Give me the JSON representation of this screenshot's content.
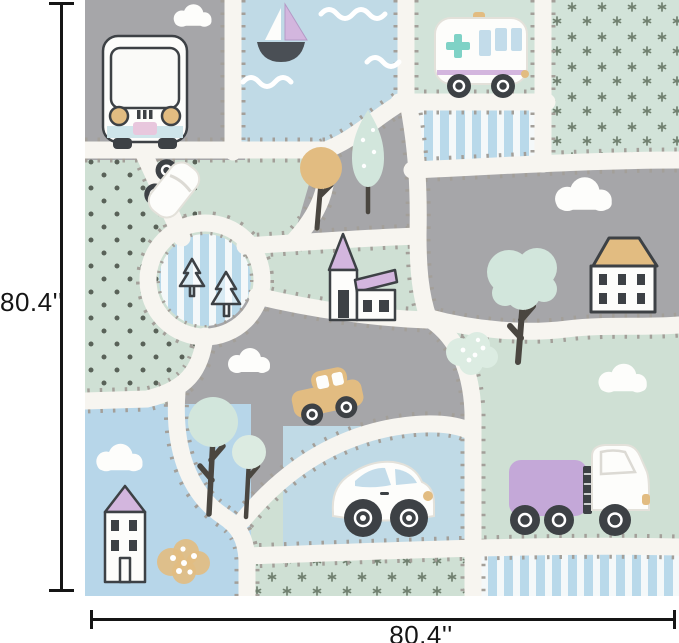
{
  "figure": {
    "kind": "product-dimension-figure",
    "subject": "kids-road-play-rug"
  },
  "dimensions": {
    "height_label": "80.4''",
    "width_label": "80.4''"
  },
  "rug": {
    "motifs": [
      "camper-van-front",
      "cloud",
      "sailboat",
      "water-waves",
      "ambulance-van",
      "striped-patch",
      "sprig-dot-patch",
      "polka-dot-patch",
      "roundabout-with-pines",
      "top-view-car",
      "orange-tree",
      "mint-tree",
      "purple-roof-house",
      "tan-roof-house",
      "pink-roof-house",
      "tan-car",
      "white-hatchback-car",
      "purple-truck",
      "tan-pebble-bush",
      "dotted-mint-bush",
      "white-roads-with-stitch-marks"
    ]
  },
  "palette": {
    "road_white": "#f7f5f0",
    "road_dash": "#a39f99",
    "gray_patch": "#a6a6a9",
    "mint": "#cfe0d4",
    "mint_light": "#d2e3d9",
    "mint_foliage": "#d2e6dc",
    "water_blue": "#c0dae6",
    "sky_blue": "#b7d6e9",
    "stripe_blue": "#b9d9ea",
    "lilac": "#c4a8d8",
    "pink_lilac": "#d3b6de",
    "tan": "#e2bc81",
    "teal": "#7fd2c6",
    "charcoal": "#3d4145",
    "trunk": "#4a4640",
    "sprig_green": "#70806f",
    "dot_green": "#596258",
    "motif_white": "#fdfdfb",
    "glass_blue": "#c3dcea",
    "dimension_black": "#151515"
  }
}
